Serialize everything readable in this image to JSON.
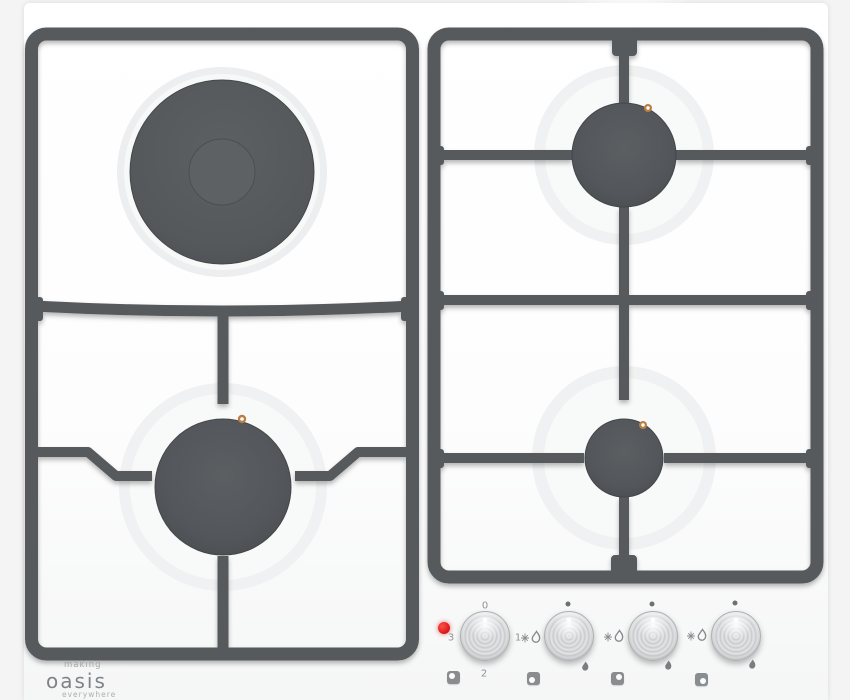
{
  "brand": {
    "making": "making",
    "name": "oasis",
    "tagline": "everywhere"
  },
  "controls": {
    "electric_knob_labels": {
      "off": "0",
      "low": "1",
      "mid": "2",
      "high": "3"
    },
    "knobs": [
      {
        "id": "electric-plate",
        "indicator": "red-led"
      },
      {
        "id": "gas-front-left",
        "indicator": "off-dot"
      },
      {
        "id": "gas-back-right",
        "indicator": "off-dot"
      },
      {
        "id": "gas-front-right",
        "indicator": "off-dot"
      }
    ]
  },
  "colors": {
    "grate_gray": "#575a5d",
    "burner_cap_gray": "#505356",
    "electric_plate_gray": "#57595c",
    "led_red": "#d81a1a",
    "electrode_orange": "#b97f42",
    "label_gray": "#8f9294",
    "logo_gray": "#7f8386",
    "surface_white": "#ffffff"
  }
}
